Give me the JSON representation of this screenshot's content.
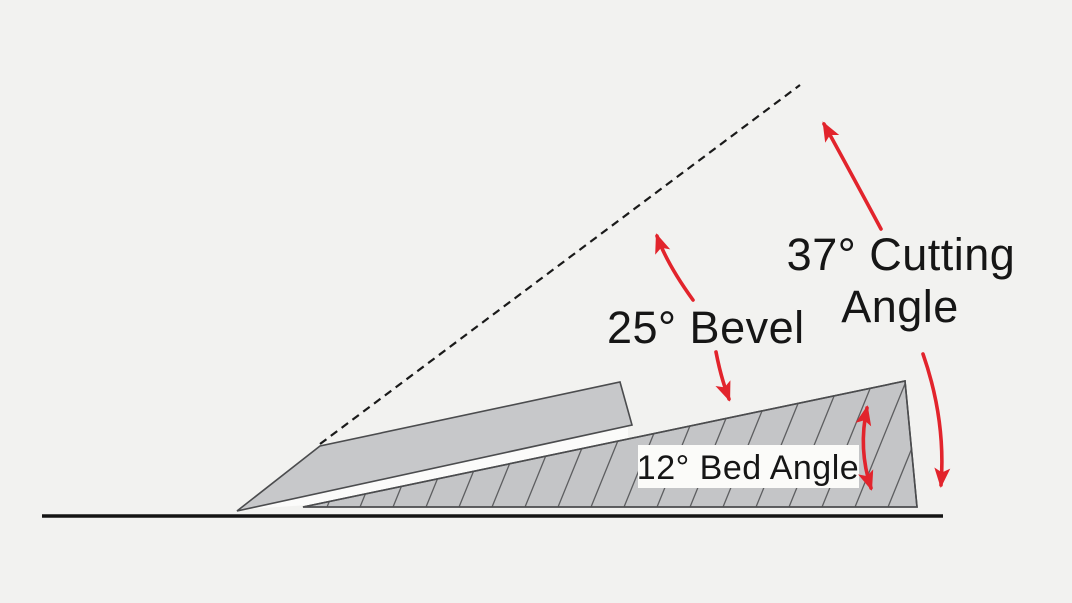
{
  "diagram": {
    "labels": {
      "cutting_angle_line1": "37° Cutting",
      "cutting_angle_line2": "Angle",
      "bevel": "25° Bevel",
      "bed_angle": "12° Bed Angle"
    },
    "angles": {
      "cutting_deg": 37,
      "bevel_deg": 25,
      "bed_deg": 12
    },
    "colors": {
      "background": "#f2f2f0",
      "blade_fill": "#c7c8ca",
      "bed_fill": "#c4c5c7",
      "outline": "#4b4c4e",
      "hatch": "#5d5e60",
      "arrow_red": "#e2242c",
      "text": "#161616",
      "label_box": "#fbfbf9"
    }
  }
}
